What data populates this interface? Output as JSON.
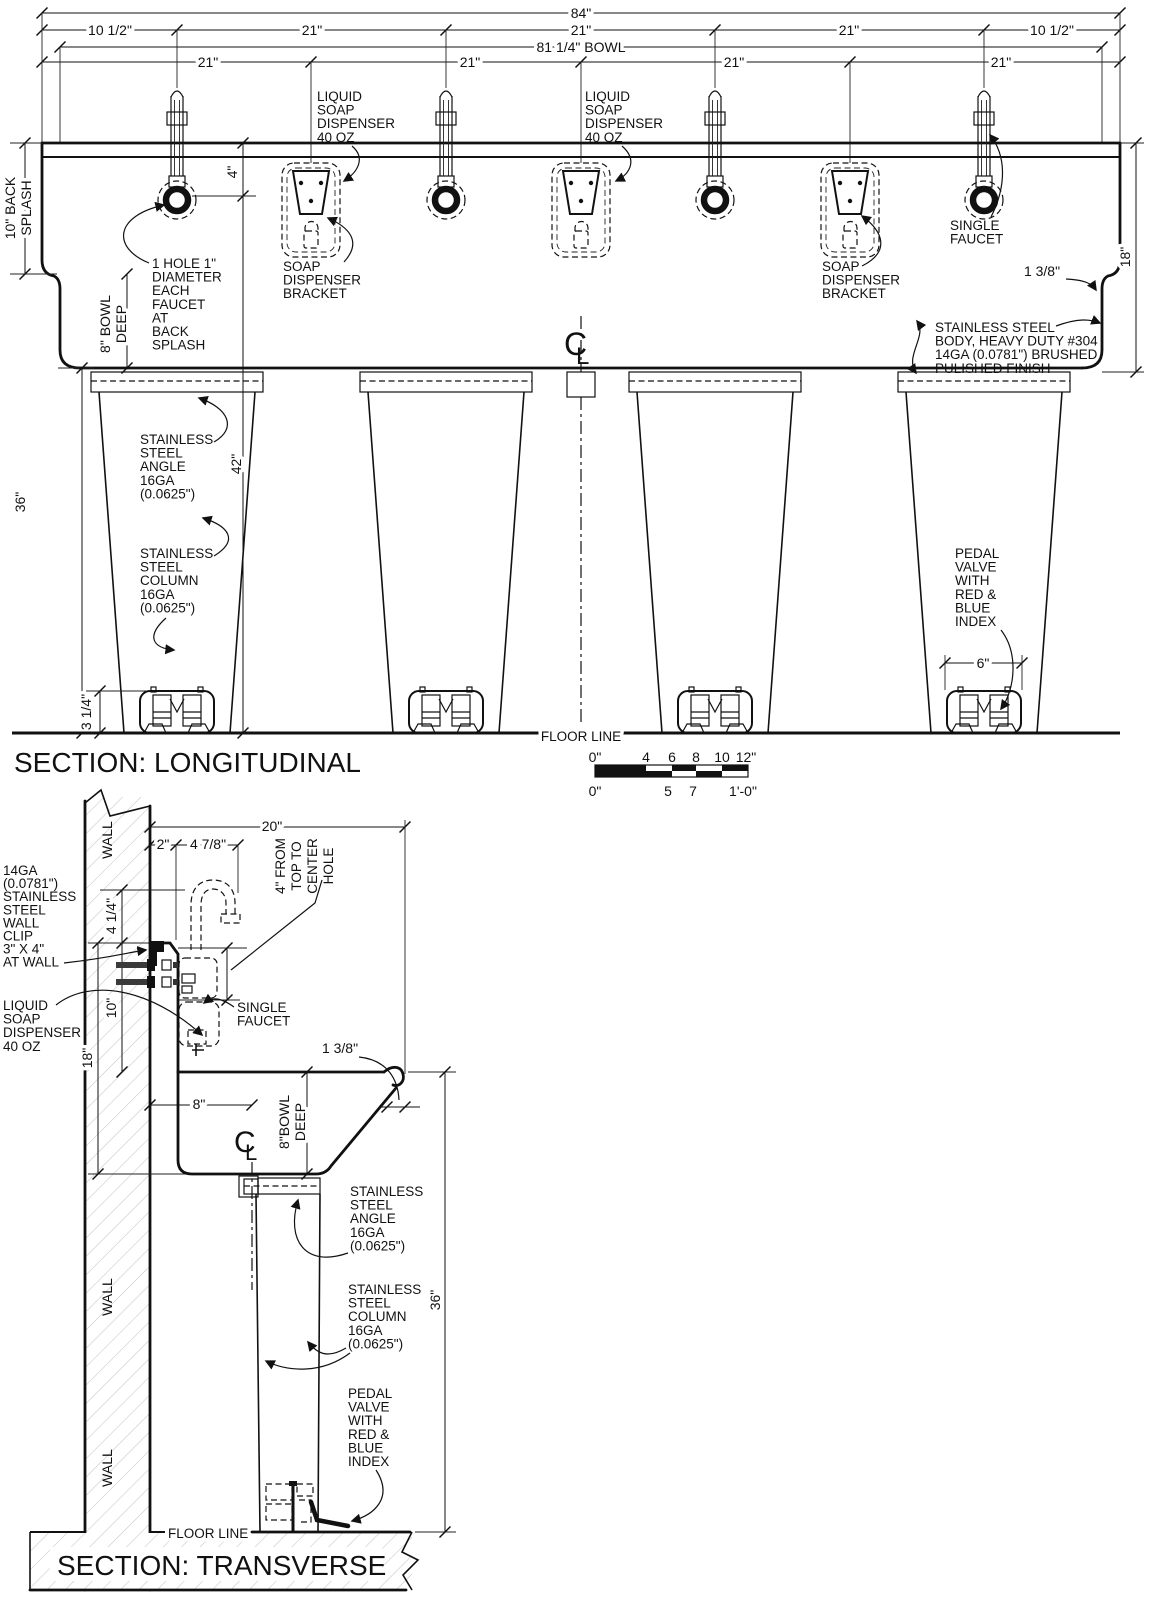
{
  "longitudinal": {
    "title": "SECTION: LONGITUDINAL",
    "dim": {
      "w84": "84\"",
      "row2": [
        "10 1/2\"",
        "21\"",
        "21\"",
        "21\"",
        "10 1/2\""
      ],
      "bowl": "81 1/4\" BOWL",
      "row4": [
        "21\"",
        "21\"",
        "21\"",
        "21\""
      ],
      "d4": "4\"",
      "d42": "42\"",
      "back_splash": [
        "10\" BACK",
        "SPLASH"
      ],
      "bowl_deep": [
        "8\" BOWL",
        "DEEP"
      ],
      "d36": "36\"",
      "d18": "18\"",
      "lip": "1 3/8\"",
      "d6": "6\"",
      "pedal_h": "3 1/4\""
    },
    "label": {
      "soap_a": [
        "LIQUID",
        "SOAP",
        "DISPENSER",
        "40 OZ"
      ],
      "soap_b": [
        "LIQUID",
        "SOAP",
        "DISPENSER",
        "40 OZ"
      ],
      "bracket_a": [
        "SOAP",
        "DISPENSER",
        "BRACKET"
      ],
      "bracket_b": [
        "SOAP",
        "DISPENSER",
        "BRACKET"
      ],
      "single_faucet": [
        "SINGLE",
        "FAUCET"
      ],
      "hole": [
        "1 HOLE 1\"",
        "DIAMETER",
        "EACH",
        "FAUCET",
        "AT",
        "BACK",
        "SPLASH"
      ],
      "body": [
        "STAINLESS STEEL",
        "BODY, HEAVY DUTY #304",
        "14GA (0.0781\") BRUSHED",
        "PULISHED FINISH"
      ],
      "angle": [
        "STAINLESS",
        "STEEL",
        "ANGLE",
        "16GA",
        "(0.0625\")"
      ],
      "column": [
        "STAINLESS",
        "STEEL",
        "COLUMN",
        "16GA",
        "(0.0625\")"
      ],
      "pedal": [
        "PEDAL",
        "VALVE",
        "WITH",
        "RED &",
        "BLUE",
        "INDEX"
      ],
      "floor": "FLOOR LINE"
    }
  },
  "scale_bar": {
    "top": [
      "0\"",
      "4",
      "6",
      "8",
      "10",
      "12\""
    ],
    "bottom": [
      "0\"",
      "5",
      "7",
      "1'-0\""
    ]
  },
  "transverse": {
    "title": "SECTION: TRANSVERSE",
    "wall": "WALL",
    "dim": {
      "w20": "20\"",
      "w2": "2\"",
      "w478": "4 7/8\"",
      "hole_note": [
        "4\" FROM",
        "TOP TO",
        "CENTER",
        "HOLE"
      ],
      "d414": "4 1/4\"",
      "d10": "10\"",
      "d18": "18\"",
      "lip": "1 3/8\"",
      "d8": "8\"",
      "bowl_deep": [
        "8\"BOWL",
        "DEEP"
      ],
      "d36": "36\""
    },
    "label": {
      "clip": [
        "14GA",
        "(0.0781\")",
        "STAINLESS",
        "STEEL",
        "WALL",
        "CLIP",
        "3\" X 4\"",
        "AT WALL"
      ],
      "soap": [
        "LIQUID",
        "SOAP",
        "DISPENSER",
        "40 OZ"
      ],
      "single_faucet": [
        "SINGLE",
        "FAUCET"
      ],
      "angle": [
        "STAINLESS",
        "STEEL",
        "ANGLE",
        "16GA",
        "(0.0625\")"
      ],
      "column": [
        "STAINLESS",
        "STEEL",
        "COLUMN",
        "16GA",
        "(0.0625\")"
      ],
      "pedal": [
        "PEDAL",
        "VALVE",
        "WITH",
        "RED &",
        "BLUE",
        "INDEX"
      ],
      "floor": "FLOOR LINE"
    }
  },
  "symbols": {
    "cl_c": "C",
    "cl_l": "L"
  }
}
